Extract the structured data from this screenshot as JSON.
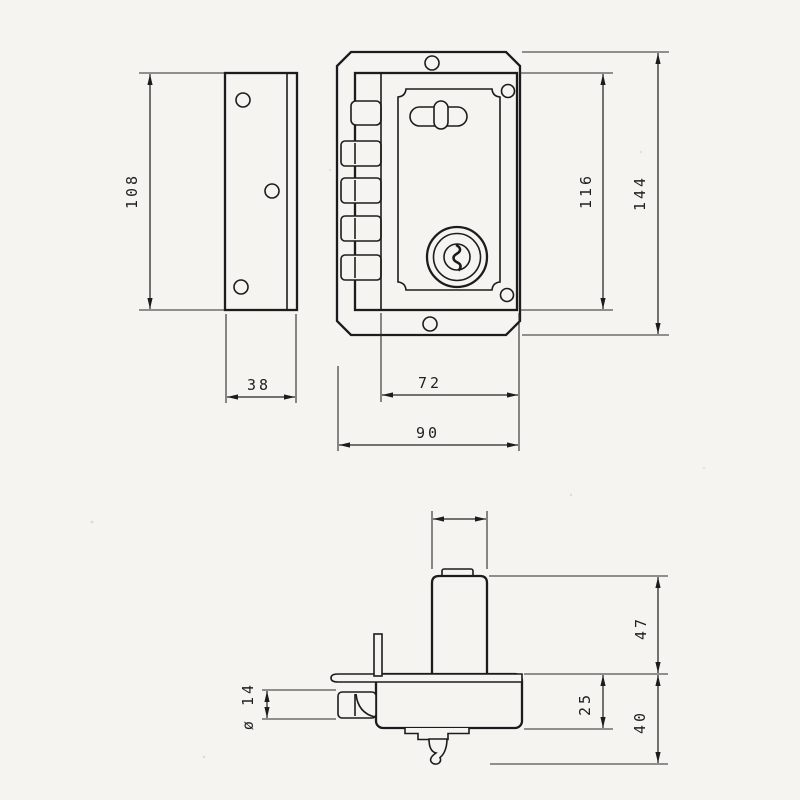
{
  "title": "rim-lock technical drawing",
  "colors": {
    "paper": "#f5f4f1",
    "ink": "#1c1c1c"
  },
  "views": {
    "strike_plate": {
      "label": "strike-plate-side-view",
      "dims": {
        "height": "108",
        "width": "38"
      }
    },
    "front": {
      "label": "lock-front-view",
      "dims": {
        "body_width": "72",
        "plate_width": "90",
        "body_height": "116",
        "plate_height": "144"
      }
    },
    "side": {
      "label": "lock-side-view",
      "dims": {
        "cylinder_height": "47",
        "case_depth": "25",
        "overall_depth": "40",
        "bolt_diameter": "ø 14"
      }
    }
  }
}
